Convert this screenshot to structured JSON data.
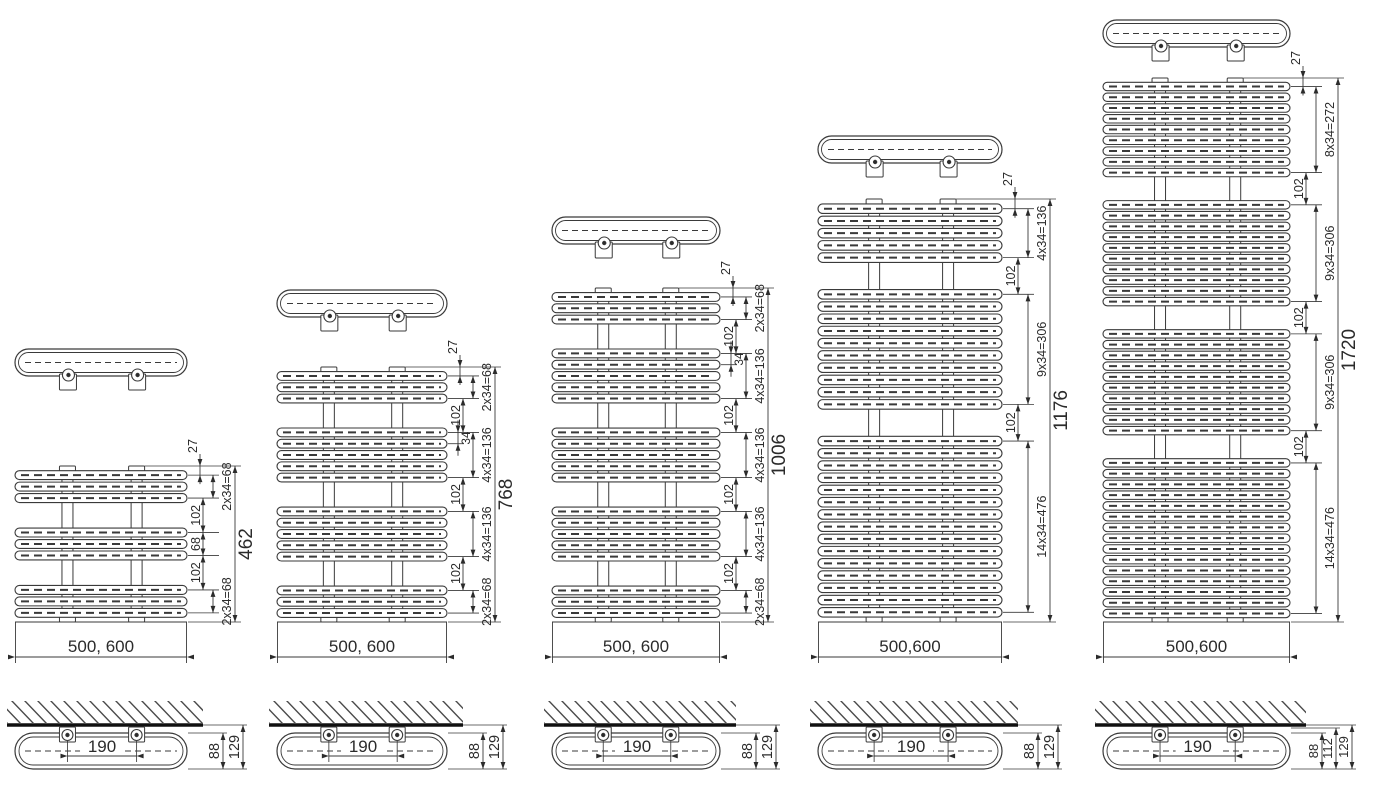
{
  "page": {
    "background": "#ffffff"
  },
  "colors": {
    "line": "#3a3a3a",
    "thin": "#4a4a4a",
    "text": "#2b2b2b",
    "wall": "#101010",
    "hatch": "#4a4a4a",
    "fill": "#ffffff"
  },
  "diagram": {
    "kind": "towel-radiator-dimension-drawing",
    "radiators": [
      {
        "name": "height-462",
        "total_label": "462",
        "total_mm": 462,
        "top_offset_label": "27",
        "top_offset_mm": 27,
        "width_label": "500, 600",
        "tube_groups": [
          3,
          3,
          3
        ],
        "segments": [
          {
            "label": "2x34=68",
            "mm": 68,
            "column": "outer"
          },
          {
            "label": "102",
            "mm": 102,
            "column": "inner"
          },
          {
            "label": "68",
            "mm": 68,
            "column": "inner"
          },
          {
            "label": "102",
            "mm": 102,
            "column": "inner"
          },
          {
            "label": "2x34=68",
            "mm": 68,
            "column": "outer"
          }
        ],
        "pitch_label": null,
        "pitch_group_index": null,
        "layout": {
          "left": 15,
          "width": 172,
          "body_top": 466,
          "loop_top": 349
        }
      },
      {
        "name": "height-768",
        "total_label": "768",
        "total_mm": 768,
        "top_offset_label": "27",
        "top_offset_mm": 27,
        "width_label": "500, 600",
        "tube_groups": [
          3,
          5,
          5,
          3
        ],
        "segments": [
          {
            "label": "2x34=68",
            "mm": 68,
            "column": "outer"
          },
          {
            "label": "102",
            "mm": 102,
            "column": "inner"
          },
          {
            "label": "4x34=136",
            "mm": 136,
            "column": "outer"
          },
          {
            "label": "102",
            "mm": 102,
            "column": "inner"
          },
          {
            "label": "4x34=136",
            "mm": 136,
            "column": "outer"
          },
          {
            "label": "102",
            "mm": 102,
            "column": "inner"
          },
          {
            "label": "2x34=68",
            "mm": 68,
            "column": "outer"
          }
        ],
        "pitch_label": "34",
        "pitch_group_index": 1,
        "layout": {
          "left": 277,
          "width": 170,
          "body_top": 367,
          "loop_top": 290
        }
      },
      {
        "name": "height-1006",
        "total_label": "1006",
        "total_mm": 1006,
        "top_offset_label": "27",
        "top_offset_mm": 27,
        "width_label": "500, 600",
        "tube_groups": [
          3,
          5,
          5,
          5,
          3
        ],
        "segments": [
          {
            "label": "2x34=68",
            "mm": 68,
            "column": "outer"
          },
          {
            "label": "102",
            "mm": 102,
            "column": "inner"
          },
          {
            "label": "4x34=136",
            "mm": 136,
            "column": "outer"
          },
          {
            "label": "102",
            "mm": 102,
            "column": "inner"
          },
          {
            "label": "4x34=136",
            "mm": 136,
            "column": "outer"
          },
          {
            "label": "102",
            "mm": 102,
            "column": "inner"
          },
          {
            "label": "4x34=136",
            "mm": 136,
            "column": "outer"
          },
          {
            "label": "102",
            "mm": 102,
            "column": "inner"
          },
          {
            "label": "2x34=68",
            "mm": 68,
            "column": "outer"
          }
        ],
        "pitch_label": "34",
        "pitch_group_index": 1,
        "layout": {
          "left": 552,
          "width": 168,
          "body_top": 288,
          "loop_top": 217
        }
      },
      {
        "name": "height-1176",
        "total_label": "1176",
        "total_mm": 1176,
        "top_offset_label": "27",
        "top_offset_mm": 27,
        "width_label": "500,600",
        "tube_groups": [
          5,
          10,
          15
        ],
        "segments": [
          {
            "label": "4x34=136",
            "mm": 136,
            "column": "outer"
          },
          {
            "label": "102",
            "mm": 102,
            "column": "inner"
          },
          {
            "label": "9x34=306",
            "mm": 306,
            "column": "outer"
          },
          {
            "label": "102",
            "mm": 102,
            "column": "inner"
          },
          {
            "label": "14x34=476",
            "mm": 476,
            "column": "outer"
          }
        ],
        "pitch_label": null,
        "pitch_group_index": null,
        "layout": {
          "left": 818,
          "width": 184,
          "body_top": 199,
          "loop_top": 136
        }
      },
      {
        "name": "height-1720",
        "total_label": "1720",
        "total_mm": 1720,
        "top_offset_label": "27",
        "top_offset_mm": 27,
        "width_label": "500,600",
        "tube_groups": [
          9,
          10,
          10,
          15
        ],
        "segments": [
          {
            "label": "8x34=272",
            "mm": 272,
            "column": "outer"
          },
          {
            "label": "102",
            "mm": 102,
            "column": "inner"
          },
          {
            "label": "9x34=306",
            "mm": 306,
            "column": "outer"
          },
          {
            "label": "102",
            "mm": 102,
            "column": "inner"
          },
          {
            "label": "9x34=306",
            "mm": 306,
            "column": "outer"
          },
          {
            "label": "102",
            "mm": 102,
            "column": "inner"
          },
          {
            "label": "14x34=476",
            "mm": 476,
            "column": "outer"
          }
        ],
        "pitch_label": null,
        "pitch_group_index": null,
        "layout": {
          "left": 1103,
          "width": 187,
          "body_top": 78,
          "loop_top": 20
        }
      }
    ],
    "side_views": [
      {
        "span_label": "190",
        "depth_label": "88",
        "mid_depth_label": null,
        "total_depth_label": "129"
      },
      {
        "span_label": "190",
        "depth_label": "88",
        "mid_depth_label": null,
        "total_depth_label": "129"
      },
      {
        "span_label": "190",
        "depth_label": "88",
        "mid_depth_label": null,
        "total_depth_label": "129"
      },
      {
        "span_label": "190",
        "depth_label": "88",
        "mid_depth_label": null,
        "total_depth_label": "129"
      },
      {
        "span_label": "190",
        "depth_label": "88",
        "mid_depth_label": "112",
        "total_depth_label": "129"
      }
    ]
  }
}
